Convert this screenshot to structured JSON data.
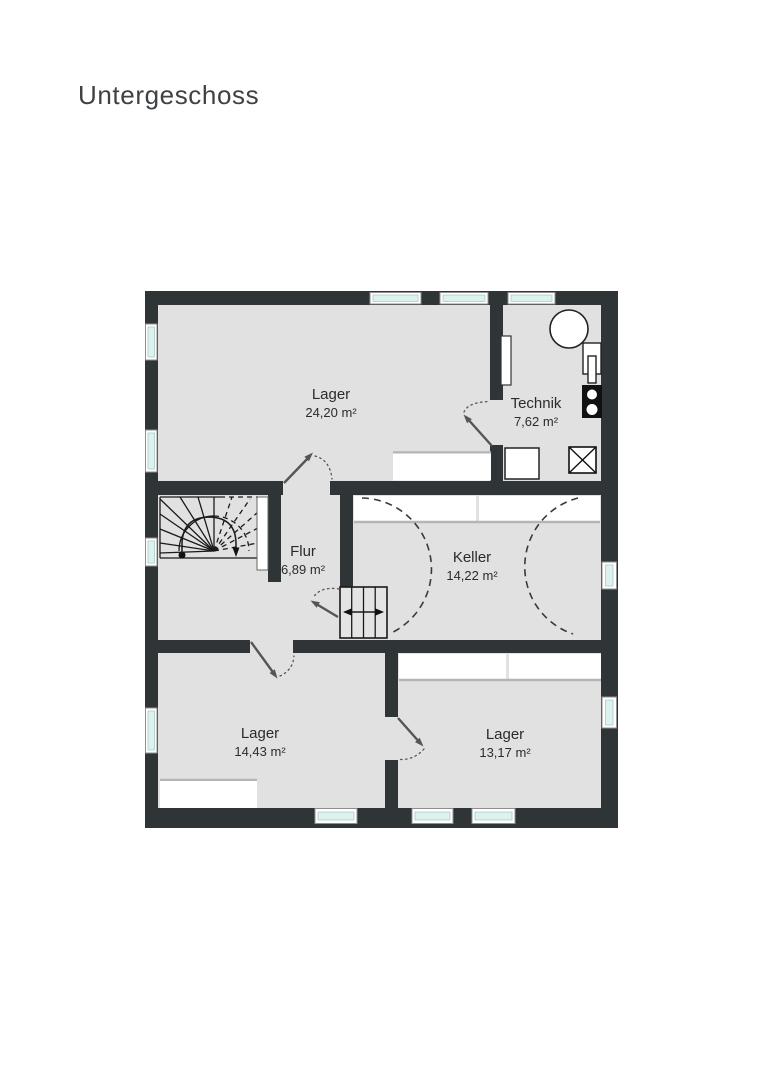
{
  "page": {
    "title": "Untergeschoss"
  },
  "floorplan": {
    "floor_name": "Untergeschoss",
    "rooms": [
      {
        "id": "lager-top",
        "name": "Lager",
        "area": "24,20 m²"
      },
      {
        "id": "technik",
        "name": "Technik",
        "area": "7,62 m²"
      },
      {
        "id": "flur",
        "name": "Flur",
        "area": "6,89 m²"
      },
      {
        "id": "keller",
        "name": "Keller",
        "area": "14,22 m²"
      },
      {
        "id": "lager-bottom-left",
        "name": "Lager",
        "area": "14,43 m²"
      },
      {
        "id": "lager-bottom-right",
        "name": "Lager",
        "area": "13,17 m²"
      }
    ],
    "colors": {
      "wall": "#2f3437",
      "floor": "#e1e1e1",
      "window_glass": "#dcf2ef",
      "label_text": "#2b2b2b",
      "door_arrow": "#555555"
    }
  }
}
